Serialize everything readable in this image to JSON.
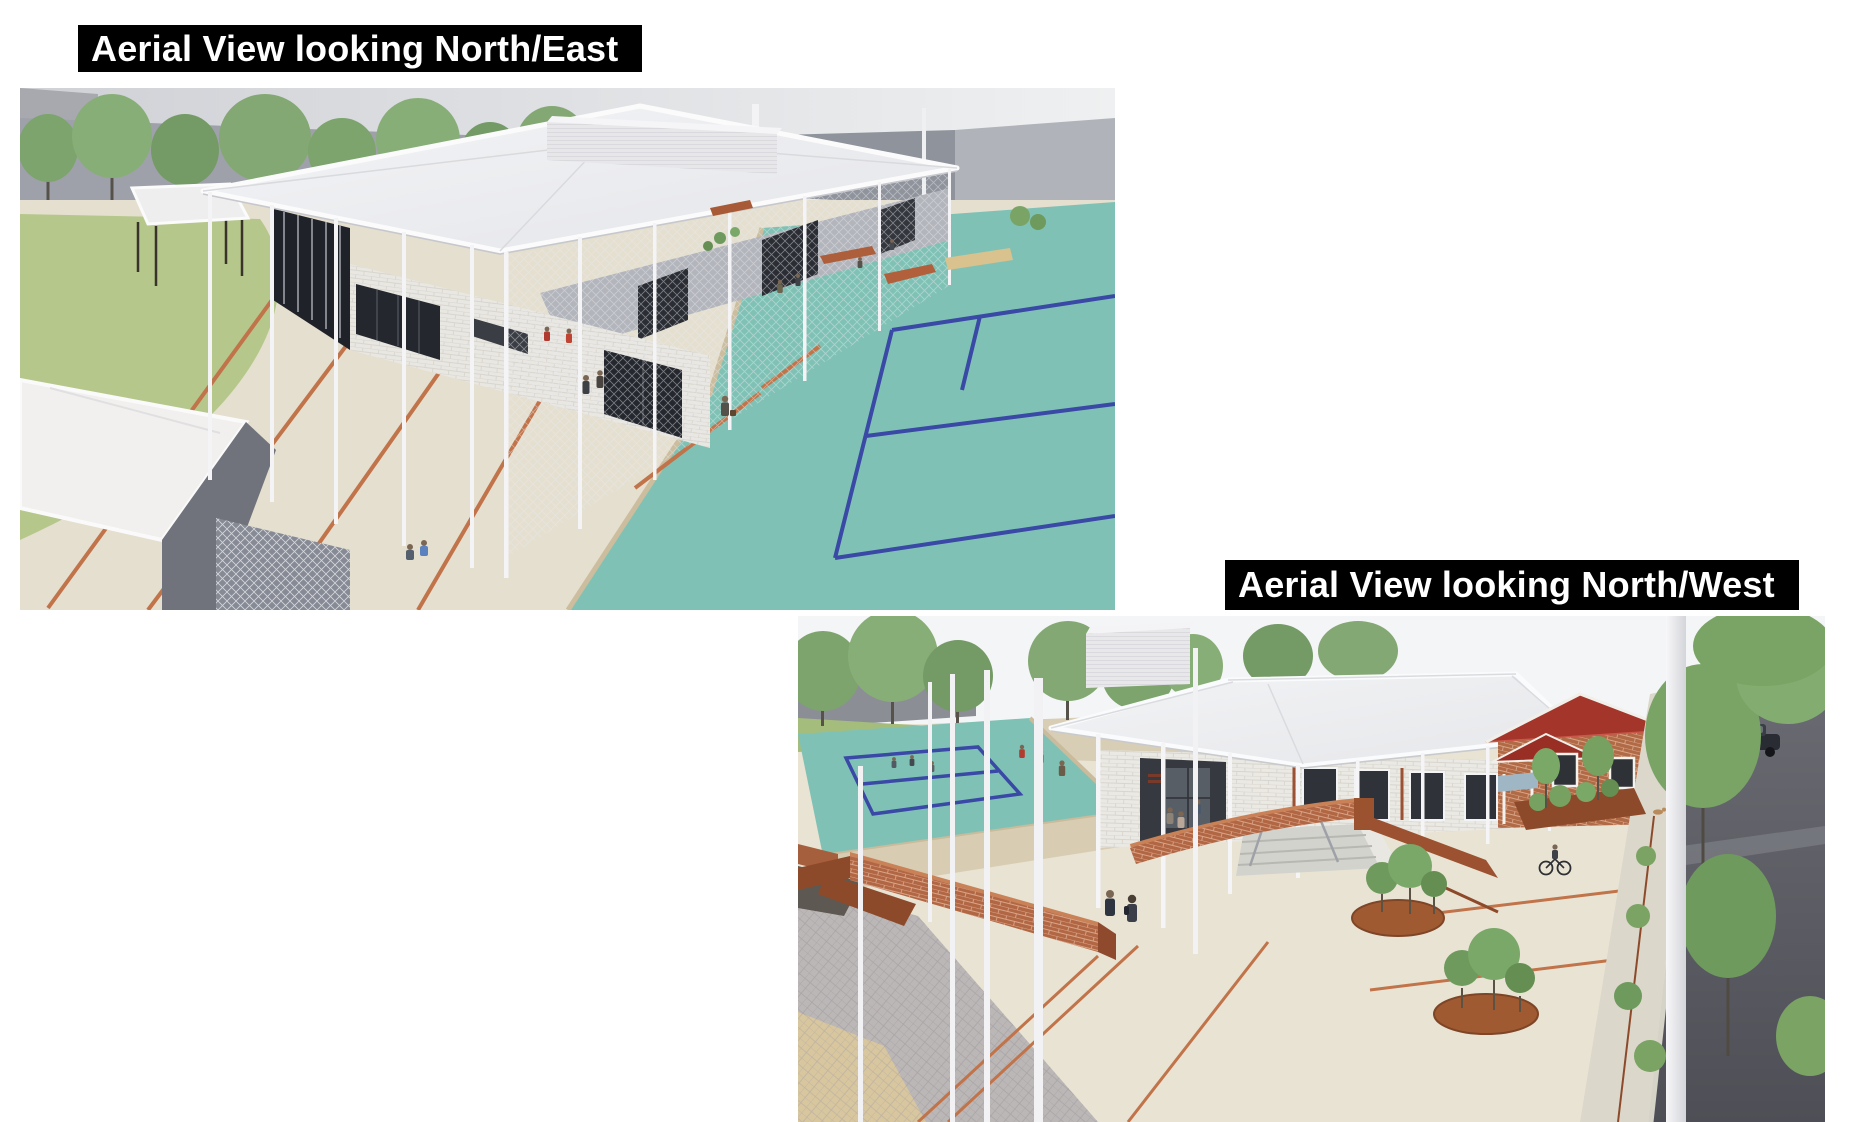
{
  "page": {
    "background": "#ffffff"
  },
  "panels": [
    {
      "id": "north-east",
      "label": "Aerial View looking North/East"
    },
    {
      "id": "north-west",
      "label": "Aerial View looking North/West"
    }
  ],
  "colors": {
    "caption_bg": "#000000",
    "caption_text": "#ffffff",
    "court_teal": "#7fc2b5",
    "court_line_blue": "#3a48a6",
    "paving_concrete": "#e6dfcf",
    "terracotta_strip": "#c1734a",
    "brick_seat_wall": "#b26744",
    "corten_steel": "#8d4a2a",
    "grass_green": "#b6c78b",
    "tree_green": "#7ca46c",
    "roof_white": "#eff0f3",
    "asphalt_road": "#5c5d64",
    "heritage_house_roof": "#a4352a",
    "background_wall_grey": "#9ea1a9"
  }
}
